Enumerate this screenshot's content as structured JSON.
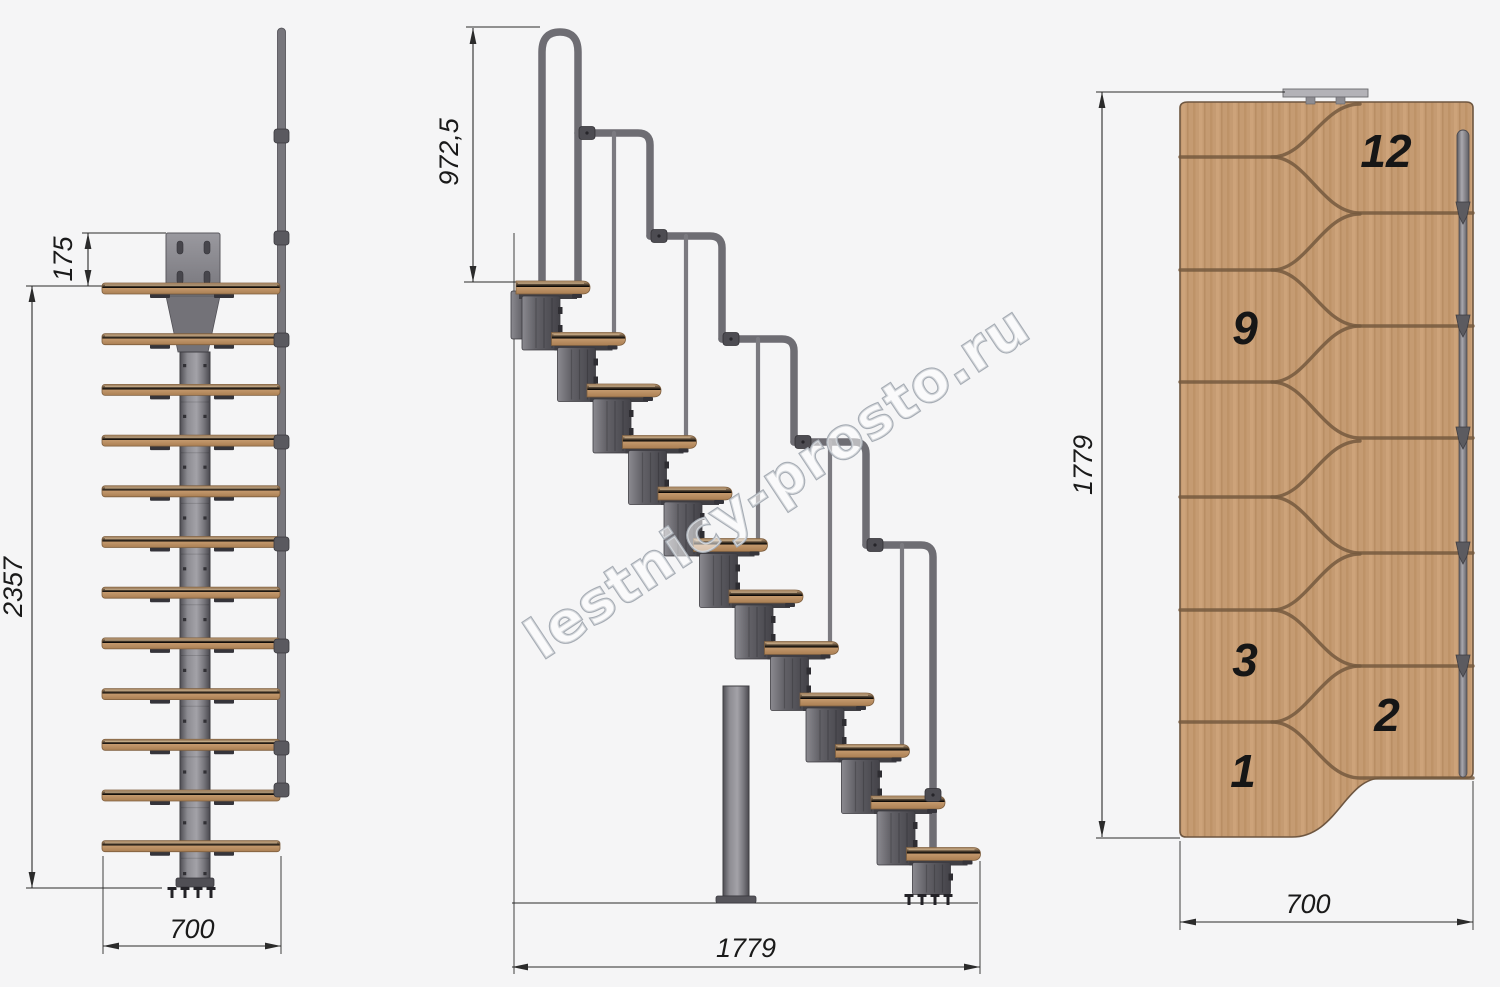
{
  "drawing": {
    "watermark": "lestnicy-prosto.ru",
    "views": {
      "front": {
        "label": "front projection",
        "dim_bracket": "175",
        "dim_height": "2357",
        "dim_width": "700"
      },
      "side": {
        "label": "side elevation",
        "dim_rail": "972,5",
        "dim_run": "1779"
      },
      "plan": {
        "label": "top plan",
        "dim_run": "1779",
        "dim_width": "700",
        "steps": {
          "s12": "12",
          "s9": "9",
          "s3": "3",
          "s2": "2",
          "s1": "1"
        }
      }
    },
    "colors": {
      "background": "#f5f5f6",
      "wood": "#c0946a",
      "wood_dark": "#7e5f3f",
      "groove": "#74593e",
      "metal": "#807f85",
      "metal_dark": "#4c4b51",
      "module": "#58575d",
      "handrail": "#6e6d73",
      "dim_line": "#2b2b2b",
      "text": "#1a1a1a",
      "watermark_stroke": "#a6acb4"
    }
  }
}
